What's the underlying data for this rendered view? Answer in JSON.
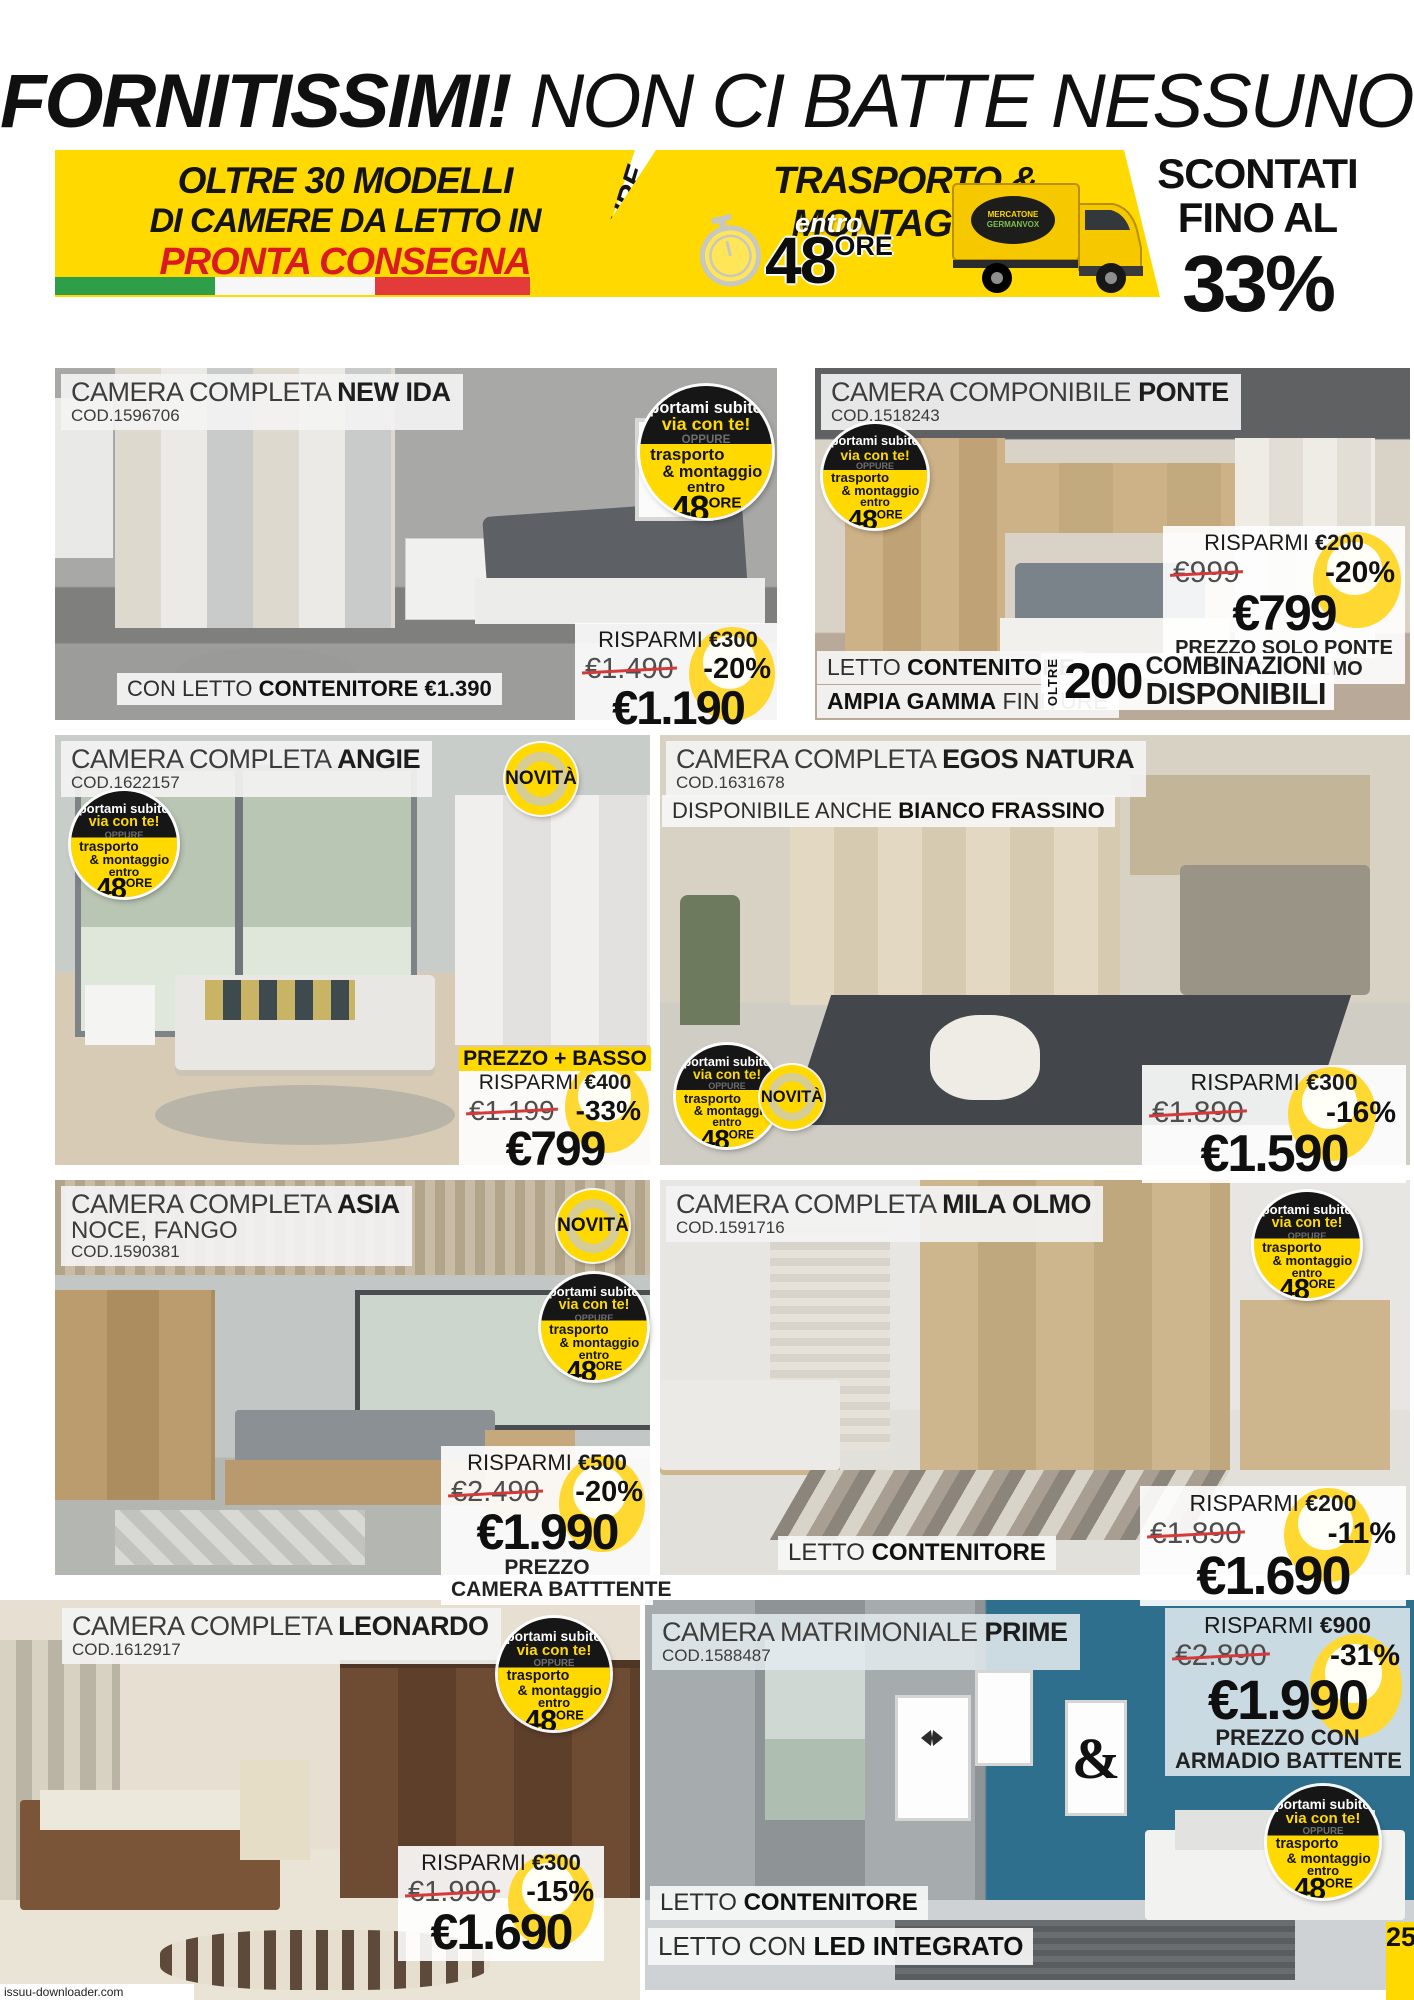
{
  "header": {
    "title_bold": "FORNITISSIMI!",
    "title_rest": " NON CI BATTE NESSUNO!"
  },
  "banner": {
    "left": {
      "line1_a": "OLTRE ",
      "line1_b": "30 MODELLI",
      "line2": "DI CAMERE DA LETTO IN",
      "line3": "PRONTA CONSEGNA"
    },
    "oppure": "OPPURE",
    "middle": {
      "title": "TRASPORTO & MONTAGGIO",
      "entro": "entro",
      "hours": "48",
      "ore": "ORE",
      "truck_logo": "MERCATONE GERMANVOX"
    },
    "right": {
      "line1": "SCONTATI",
      "line2": "FINO AL",
      "pct": "33%"
    }
  },
  "badge": {
    "l1": "portami subito",
    "l2": "via con te!",
    "l3": "OPPURE",
    "l4": "trasporto",
    "l5": "& montaggio",
    "l6": "entro",
    "hours": "48",
    "ore": "ORE"
  },
  "novita": "NOVITÀ",
  "colors": {
    "accent_yellow": "#ffd900",
    "price_red": "#d91a21",
    "flag_green": "#2e9e49",
    "flag_red": "#e33a3a"
  },
  "cards": [
    {
      "title_prefix": "CAMERA COMPLETA ",
      "title_name": "NEW IDA",
      "cod": "COD.1596706",
      "risparmi_prefix": "RISPARMI ",
      "risparmi": "€300",
      "old": "€1.490",
      "disc": "-20%",
      "price": "€1.190",
      "note_prefix": "CON LETTO ",
      "note_bold": "CONTENITORE €1.390"
    },
    {
      "title_prefix": "CAMERA COMPONIBILE ",
      "title_name": "PONTE",
      "cod": "COD.1518243",
      "risparmi_prefix": "RISPARMI ",
      "risparmi": "€200",
      "old": "€999",
      "disc": "-20%",
      "price": "€799",
      "price_note1": "PREZZO SOLO PONTE",
      "price_note2": "TUTTO IN OLMO",
      "bar1_a": "LETTO ",
      "bar1_b": "CONTENITORE",
      "bar2_a": "AMPIA GAMMA",
      "bar2_b": " FINITURE",
      "oltre": "OLTRE",
      "combo_n": "200",
      "combo_l1": "COMBINAZIONI",
      "combo_l2": "DISPONIBILI"
    },
    {
      "title_prefix": "CAMERA COMPLETA ",
      "title_name": "ANGIE",
      "cod": "COD.1622157",
      "prezzo_basso_a": "PREZZO + ",
      "prezzo_basso_b": "BASSO",
      "risparmi_prefix": "RISPARMI ",
      "risparmi": "€400",
      "old": "€1.199",
      "disc": "-33%",
      "price": "€799"
    },
    {
      "title_prefix": "CAMERA COMPLETA ",
      "title_name": "EGOS NATURA",
      "cod": "COD.1631678",
      "avail_a": "DISPONIBILE ANCHE ",
      "avail_b": "BIANCO FRASSINO",
      "risparmi_prefix": "RISPARMI ",
      "risparmi": "€300",
      "old": "€1.890",
      "disc": "-16%",
      "price": "€1.590"
    },
    {
      "title_prefix": "CAMERA COMPLETA ",
      "title_name": "ASIA",
      "subtitle": "NOCE, FANGO",
      "cod": "COD.1590381",
      "risparmi_prefix": "RISPARMI ",
      "risparmi": "€500",
      "old": "€2.490",
      "disc": "-20%",
      "price": "€1.990",
      "price_note1": "PREZZO",
      "price_note2": "CAMERA BATTTENTE"
    },
    {
      "title_prefix": "CAMERA COMPLETA ",
      "title_name": "MILA OLMO",
      "cod": "COD.1591716",
      "risparmi_prefix": "RISPARMI ",
      "risparmi": "€200",
      "old": "€1.890",
      "disc": "-11%",
      "price": "€1.690",
      "bar1_a": "LETTO ",
      "bar1_b": "CONTENITORE"
    },
    {
      "title_prefix": "CAMERA COMPLETA ",
      "title_name": "LEONARDO",
      "cod": "COD.1612917",
      "risparmi_prefix": "RISPARMI ",
      "risparmi": "€300",
      "old": "€1.990",
      "disc": "-15%",
      "price": "€1.690"
    },
    {
      "title_prefix": "CAMERA MATRIMONIALE ",
      "title_name": "PRIME",
      "cod": "COD.1588487",
      "risparmi_prefix": "RISPARMI ",
      "risparmi": "€900",
      "old": "€2.890",
      "disc": "-31%",
      "price": "€1.990",
      "price_note1": "PREZZO CON",
      "price_note2": "ARMADIO BATTENTE",
      "poster_amp": "&",
      "bar1_a": "LETTO ",
      "bar1_b": "CONTENITORE",
      "bar2_a": "LETTO CON ",
      "bar2_b": "LED INTEGRATO"
    }
  ],
  "footer": {
    "page": "25",
    "watermark": "issuu-downloader.com"
  }
}
